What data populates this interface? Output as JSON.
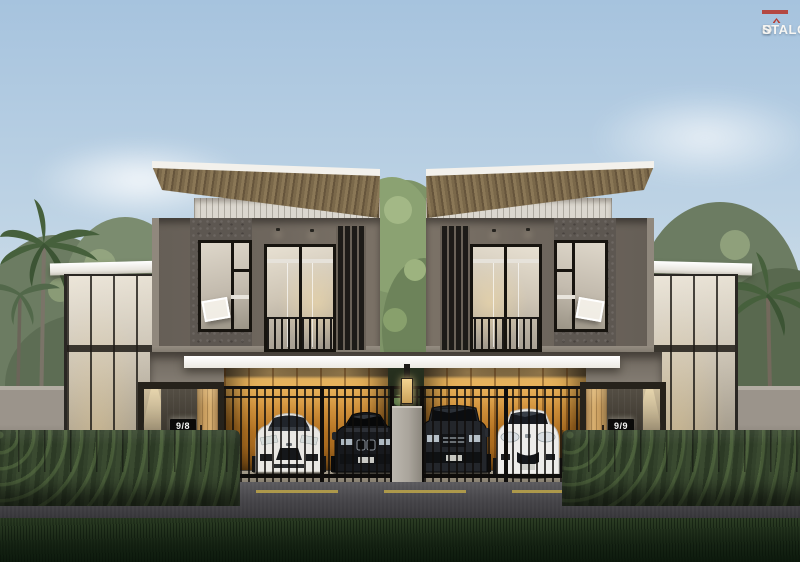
{
  "logo": {
    "name_prefix": "N",
    "name_o": "O",
    "name_suffix": "STALGIA",
    "accent_color": "#b63b30"
  },
  "houses": {
    "left": {
      "number": "9/8"
    },
    "right": {
      "number": "9/9"
    }
  },
  "scene": {
    "subject": "twin-modern-two-storey-houses-render",
    "vehicles": [
      "white-sports-car",
      "black-sedan",
      "dark-suv",
      "white-hatchback"
    ],
    "colors": {
      "sky_top": "#a6c3de",
      "sky_horizon": "#eceeea",
      "roof_wood": "#7a684a",
      "wall_taupe": "#6f675e",
      "canopy": "#ece9e2",
      "garage_wood": "#c5812a",
      "wood_door": "#c79b5c",
      "hedge": "#33422b",
      "road": "#48474b",
      "lane_yellow": "#b7a04a",
      "grass": "#162414",
      "concrete": "#aaa59c",
      "logo_accent": "#b63b30"
    }
  }
}
